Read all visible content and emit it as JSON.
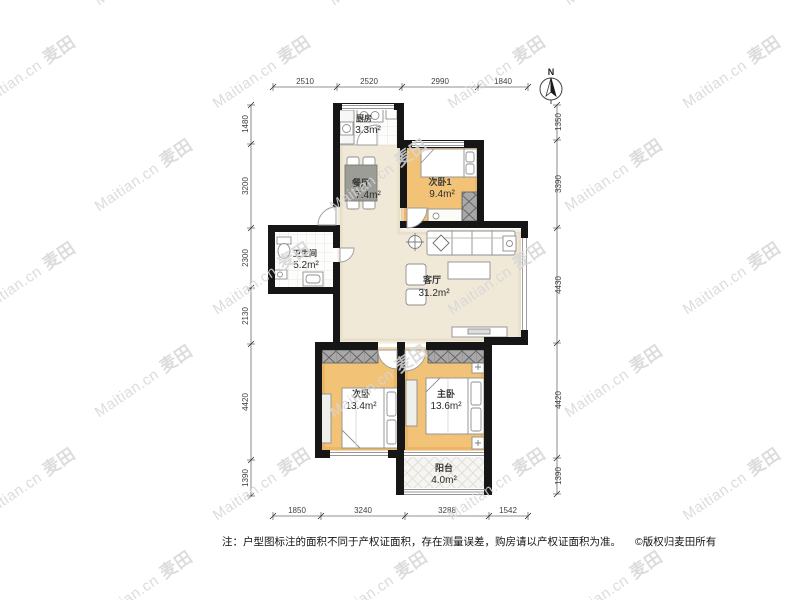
{
  "rooms": [
    {
      "id": "kitchen",
      "name": "厨房",
      "area": "3.3m²"
    },
    {
      "id": "dining",
      "name": "餐厅",
      "area": "7.4m²"
    },
    {
      "id": "bedroom2-1",
      "name": "次卧1",
      "area": "9.4m²"
    },
    {
      "id": "bathroom",
      "name": "卫生间",
      "area": "5.2m²"
    },
    {
      "id": "living",
      "name": "客厅",
      "area": "31.2m²"
    },
    {
      "id": "bedroom2",
      "name": "次卧",
      "area": "13.4m²"
    },
    {
      "id": "master",
      "name": "主卧",
      "area": "13.6m²"
    },
    {
      "id": "balcony",
      "name": "阳台",
      "area": "4.0m²"
    }
  ],
  "dimensions": {
    "top": [
      "2510",
      "2520",
      "2990",
      "1840"
    ],
    "bottom": [
      "1850",
      "3240",
      "3288",
      "1542"
    ],
    "left": [
      "1480",
      "3200",
      "2300",
      "2130",
      "4420",
      "1390"
    ],
    "right": [
      "1350",
      "3390",
      "4430",
      "4420",
      "1390"
    ]
  },
  "compass": {
    "label": "N"
  },
  "note": "注：户型图标注的面积不同于产权证面积，存在测量误差，购房请以产权证面积为准。",
  "copyright": "©版权归麦田所有",
  "watermark": {
    "text": "Maitian.cn",
    "brand": "麦田",
    "color": "#d6d6d6"
  },
  "colors": {
    "wall": "#161616",
    "bedroomFloor": "#f2c377",
    "livingFloor": "#f0e9d8",
    "tileLine": "#e3e3e1",
    "wardrobe": "#a8a8a8"
  }
}
